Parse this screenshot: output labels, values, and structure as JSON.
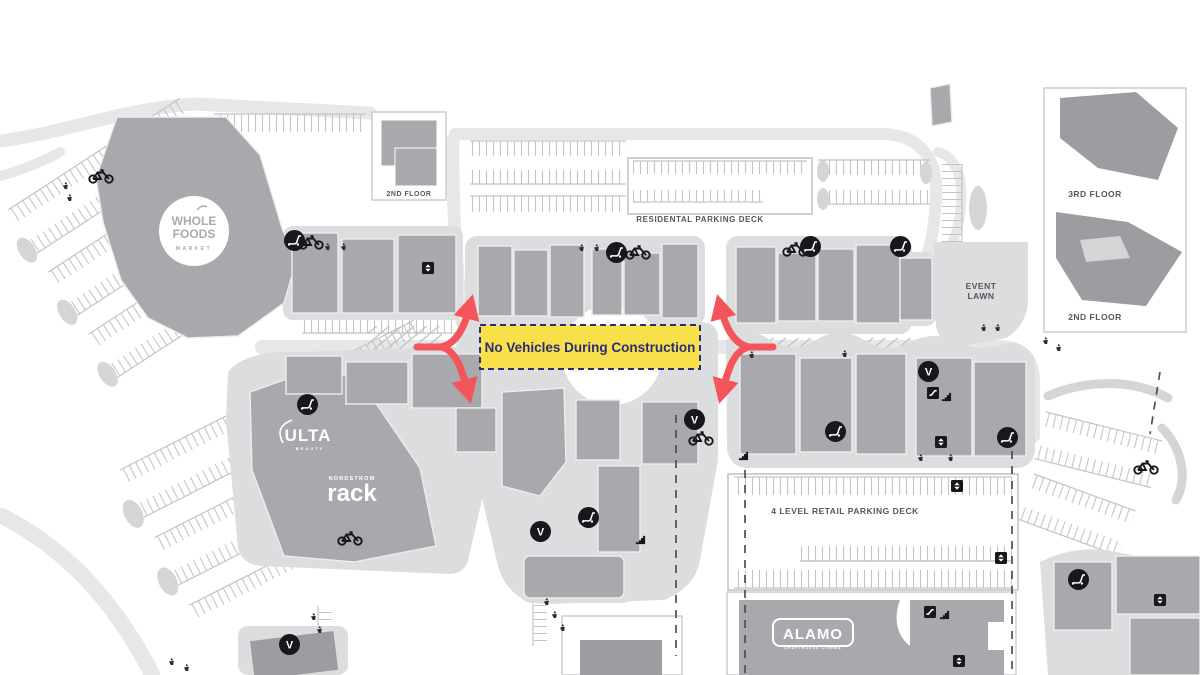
{
  "map": {
    "construction_notice": "No Vehicles During Construction",
    "labels": {
      "residential_parking_deck": "RESIDENTAL PARKING DECK",
      "second_floor_top": "2ND FLOOR",
      "event_lawn_line1": "EVENT",
      "event_lawn_line2": "LAWN",
      "third_floor": "3RD FLOOR",
      "second_floor_right": "2ND FLOOR",
      "retail_parking_deck": "4 LEVEL RETAIL PARKING DECK"
    },
    "stores": {
      "whole_foods": {
        "line1": "WHOLE",
        "line2": "FOODS",
        "line3": "MARKET"
      },
      "ulta": {
        "name": "ULTA",
        "sub": "BEAUTY"
      },
      "nordstrom_rack": {
        "name": "NORDSTROM",
        "sub": "rack"
      },
      "alamo": {
        "name": "ALAMO",
        "sub": "DRAFTHOUSE CINEMA"
      }
    },
    "icons": {
      "valet_letter": "V",
      "legend": [
        "valet",
        "bike-rack",
        "scooter-parking",
        "elevator",
        "escalator",
        "stairs",
        "accessible-parking"
      ]
    },
    "colors": {
      "construction_yellow": "#f8e04a",
      "construction_navy": "#2b2d77",
      "arrow_red": "#f4555a",
      "building_gray": "#a7a9ac",
      "building_dark_gray": "#9b9da0",
      "road_gray": "#e6e7e8",
      "pad_gray": "#dcdddf",
      "label_gray": "#55565a"
    }
  }
}
